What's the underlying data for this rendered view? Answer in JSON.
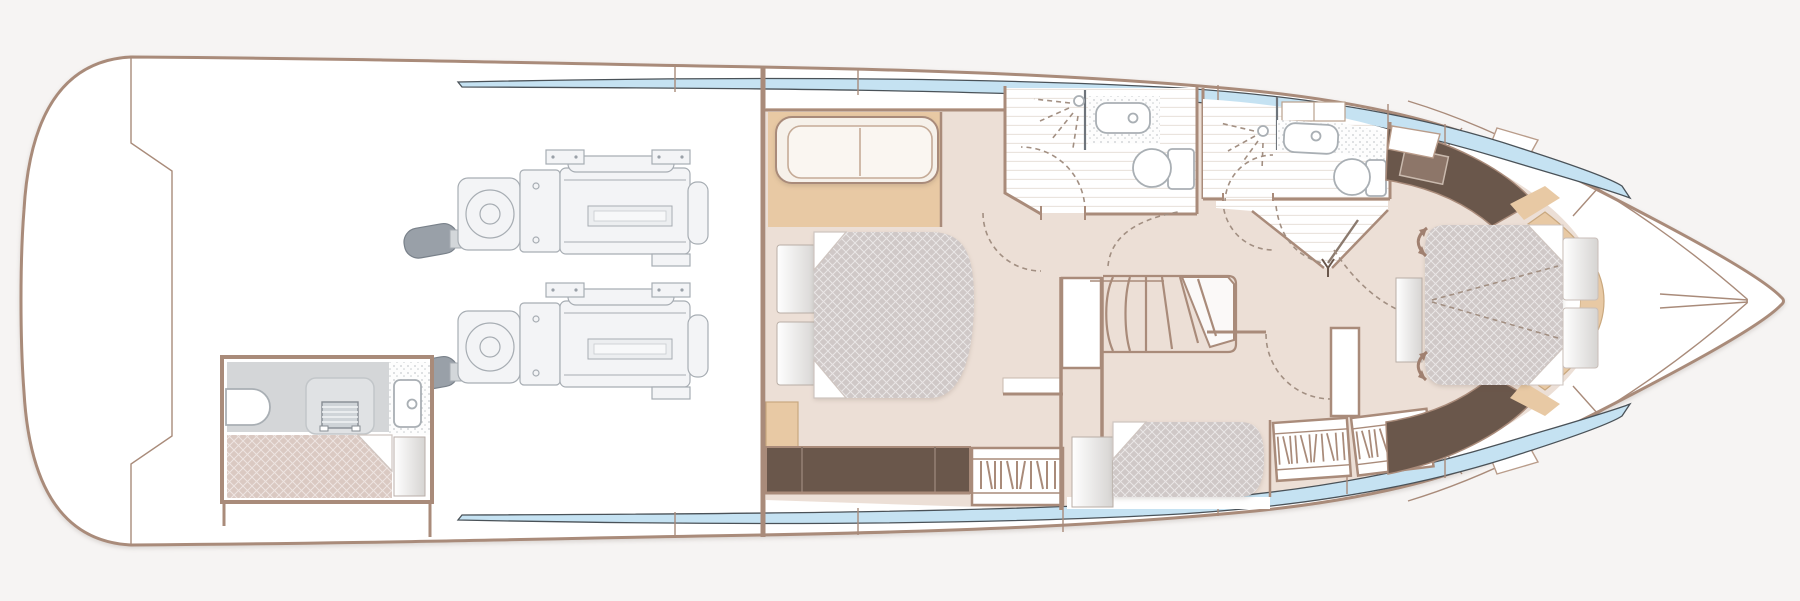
{
  "title": "yacht-lower-deck-floor-plan",
  "colors": {
    "background": "#f6f4f3",
    "hull_outline": "#a98b7a",
    "wall": "#a98b7a",
    "floor_beige": "#ecdfd6",
    "tan_accent": "#e8c9a4",
    "dark_wood": "#6a574b",
    "window_glass": "#c5e2f2",
    "window_edge": "#4a5258",
    "mattress_gray": "#cfc8c7",
    "crew_mattress": "#dac9c2",
    "shower_floor": "#d4d6d8",
    "fixture_stroke": "#a9afb4",
    "plank_line": "#eae4de",
    "speckle_dot": "#c8cccf",
    "dashed_symbol": "#a28f82",
    "engine_fill": "#f3f4f6",
    "engine_stroke": "#a7adb3",
    "engine_dark": "#99a0a8",
    "gradient_shade": "#d6d4d2",
    "white": "#ffffff"
  },
  "legend": {
    "regions": [
      "engine-room",
      "crew-cabin",
      "master-cabin",
      "aft-bathroom",
      "forward-bathroom",
      "lobby",
      "staircase",
      "mid-cabin",
      "forward-cabin",
      "bow-deck"
    ],
    "fixtures": [
      "engine",
      "propeller-shaft",
      "toilet",
      "sink",
      "shower-head",
      "shower-screen",
      "staircase-treads",
      "double-bed",
      "single-berth",
      "sofa",
      "pillow",
      "nightstand",
      "sideboard",
      "wardrobe-hangers",
      "door-swing-arc",
      "sliding-berth-arrow",
      "hull-window-strip"
    ]
  },
  "text": {
    "visible_labels": []
  }
}
